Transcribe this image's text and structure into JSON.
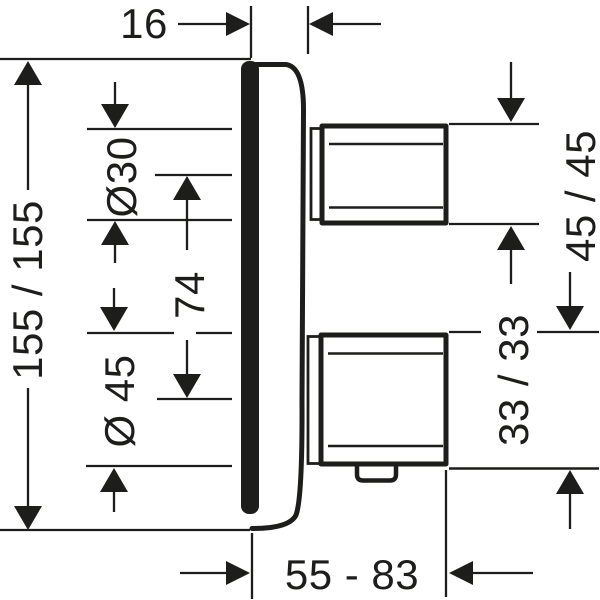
{
  "canvas": {
    "background": "#ffffff",
    "ink": "#1d1d1b"
  },
  "drawing": {
    "labels": {
      "plate_depth": "16",
      "plate_size": "155 / 155",
      "upper_sleeve_diameter": "Ø30",
      "handle_distance": "74",
      "lower_sleeve_diameter": "Ø 45",
      "upper_handle": "45 / 45",
      "lower_handle": "33 / 33",
      "depth_range": "55 - 83"
    }
  }
}
